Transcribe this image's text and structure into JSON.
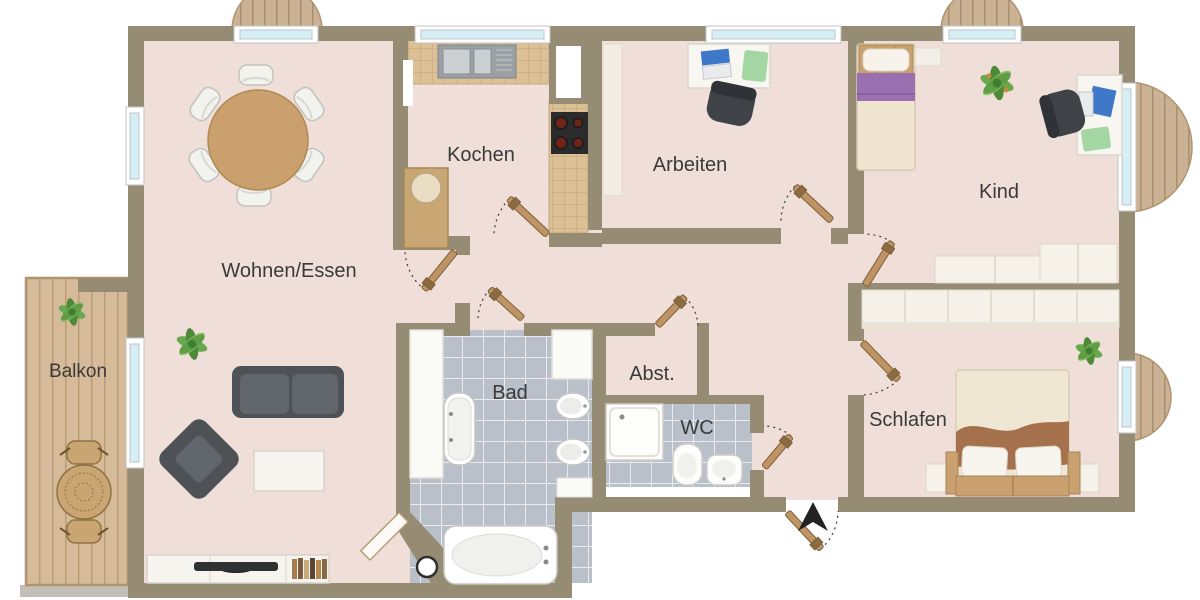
{
  "plan": {
    "type": "apartment-floor-plan",
    "rooms": {
      "wohnen_essen": {
        "label": "Wohnen/Essen"
      },
      "kochen": {
        "label": "Kochen"
      },
      "arbeiten": {
        "label": "Arbeiten"
      },
      "kind": {
        "label": "Kind"
      },
      "schlafen": {
        "label": "Schlafen"
      },
      "bad": {
        "label": "Bad"
      },
      "abstellraum": {
        "label": "Abst."
      },
      "wc": {
        "label": "WC"
      },
      "balkon": {
        "label": "Balkon"
      }
    },
    "colors": {
      "wall": "#968c74",
      "floor": "#efdfd8",
      "kitchen_tile": "#dcc096",
      "bath_tile": "#b9c0ca",
      "wood": "#cfb493",
      "window_glass": "#d6eff6",
      "door_wood": "#bf9464",
      "text": "#3a3a3a",
      "sofa_gray": "#54585c",
      "pillow_purple": "#9b70b0",
      "blanket_brown": "#a5714c",
      "plant_green": "#5f9e45",
      "steel": "#9aa0a4",
      "arrow_black": "#222222"
    },
    "icons": {
      "wohnen_essen": [
        "dining-table-icon",
        "dining-chair-icon",
        "sofa-icon",
        "armchair-icon",
        "coffee-table-icon",
        "tv-lowboard-icon",
        "tv-icon",
        "books-icon",
        "plant-icon"
      ],
      "kochen": [
        "kitchen-counter-icon",
        "sink-unit-icon",
        "stove-icon",
        "cabinet-icon"
      ],
      "arbeiten": [
        "desk-icon",
        "laptop-icon",
        "office-chair-icon",
        "desk-pad-icon"
      ],
      "kind": [
        "bed-icon",
        "pillow-icon",
        "shelf-icon",
        "desk-icon",
        "laptop-icon",
        "office-chair-icon",
        "wardrobe-icon",
        "plant-icon"
      ],
      "schlafen": [
        "double-bed-icon",
        "wardrobe-icon",
        "nightstand-icon",
        "plant-icon"
      ],
      "bad": [
        "bathtub-icon",
        "small-tub-icon",
        "washbasin-icon",
        "cabinet-icon",
        "stool-icon"
      ],
      "wc": [
        "shower-icon",
        "toilet-icon",
        "washbasin-icon"
      ],
      "balkon": [
        "garden-table-icon",
        "garden-chair-icon",
        "plant-icon"
      ],
      "entrance": "entry-direction-arrow-icon",
      "doors": "door-swing-icon",
      "windows": "window-icon"
    }
  }
}
